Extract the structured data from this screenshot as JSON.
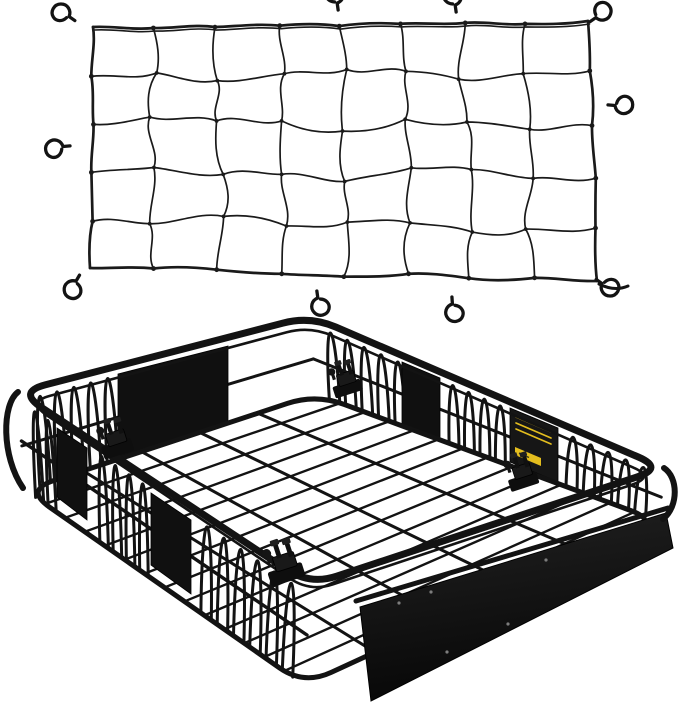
{
  "canvas": {
    "width": 679,
    "height": 709
  },
  "scene": {
    "type": "product-photo",
    "alt": "Black elastic bungee cargo net with steel hooks above a black steel roof rack cargo basket with mounting clamps",
    "items": [
      "elastic bungee cargo net with hooks",
      "steel roof rack cargo basket"
    ]
  },
  "colors": {
    "background": "#ffffff",
    "ink": "#131313",
    "strand": "#1a1a1a",
    "panel": "#101010",
    "panel_edge": "#2c2c2c",
    "fairing_top": "#222222",
    "fairing_bottom": "#070707",
    "label_plate": "#161616",
    "label_yellow": "#e3bd1e",
    "screw": "#7d7d7d"
  },
  "net": {
    "corners": {
      "tl": [
        93,
        27
      ],
      "tr": [
        588,
        21
      ],
      "br": [
        597,
        281
      ],
      "bl": [
        90,
        268
      ]
    },
    "cols": 8,
    "rows": 5,
    "border_width": 2.7,
    "strand_width": 1.7,
    "hook_count": 10,
    "hooks": [
      {
        "x": 74,
        "y": 20,
        "rot": -55
      },
      {
        "x": 338,
        "y": 9,
        "rot": -8
      },
      {
        "x": 456,
        "y": 11,
        "rot": -8
      },
      {
        "x": 591,
        "y": 21,
        "rot": 55
      },
      {
        "x": 609,
        "y": 105,
        "rot": 95
      },
      {
        "x": 69,
        "y": 146,
        "rot": -95
      },
      {
        "x": 79,
        "y": 276,
        "rot": -150
      },
      {
        "x": 317,
        "y": 292,
        "rot": 172
      },
      {
        "x": 452,
        "y": 298,
        "rot": 176
      },
      {
        "x": 597,
        "y": 280,
        "rot": 125,
        "tail": true
      }
    ]
  },
  "rack": {
    "rim": [
      [
        18,
        392
      ],
      [
        310,
        316
      ],
      [
        664,
        468
      ],
      [
        310,
        585
      ]
    ],
    "rim_inner": [
      [
        27,
        402
      ],
      [
        310,
        326
      ],
      [
        655,
        477
      ],
      [
        310,
        592
      ]
    ],
    "floor": [
      [
        25,
        490
      ],
      [
        316,
        394
      ],
      [
        659,
        521
      ],
      [
        304,
        685
      ]
    ],
    "long_bars": 13,
    "cross_bars": 4,
    "walls": {
      "far_left": {
        "arch_segs": [
          [
            0.04,
            0.33,
            5
          ]
        ]
      },
      "far_right": {
        "arch_segs": [
          [
            0.03,
            0.27,
            5
          ],
          [
            0.38,
            0.56,
            4
          ],
          [
            0.72,
            0.97,
            5
          ]
        ]
      },
      "near_left": {
        "arch_segs": [
          [
            0.03,
            0.12,
            2
          ],
          [
            0.26,
            0.45,
            4
          ],
          [
            0.62,
            0.97,
            6
          ]
        ]
      }
    },
    "panels": {
      "far_left": [
        [
          118,
          374
        ],
        [
          228,
          346
        ],
        [
          228,
          424
        ],
        [
          118,
          458
        ]
      ],
      "far_right": [
        [
          402,
          362
        ],
        [
          440,
          378
        ],
        [
          440,
          440
        ],
        [
          402,
          424
        ]
      ],
      "near_left_1": [
        [
          57,
          428
        ],
        [
          87,
          448
        ],
        [
          87,
          520
        ],
        [
          57,
          497
        ]
      ],
      "near_left_2": [
        [
          151,
          493
        ],
        [
          191,
          520
        ],
        [
          191,
          594
        ],
        [
          151,
          565
        ]
      ]
    },
    "fairing": [
      [
        360,
        607
      ],
      [
        666,
        513
      ],
      [
        673,
        548
      ],
      [
        371,
        701
      ]
    ],
    "fairing_rail": [
      [
        356,
        601
      ],
      [
        668,
        508
      ]
    ],
    "screws": [
      [
        399,
        603
      ],
      [
        431,
        592
      ],
      [
        447,
        652
      ],
      [
        508,
        624
      ],
      [
        546,
        560
      ]
    ],
    "label": {
      "plate": [
        [
          510,
          408
        ],
        [
          558,
          428
        ],
        [
          558,
          482
        ],
        [
          510,
          462
        ]
      ],
      "lines": [
        [
          516,
          417
        ],
        [
          516,
          423
        ],
        [
          516,
          429
        ]
      ],
      "line_dx": 35,
      "line_dy": 15,
      "sticker": [
        [
          515,
          447
        ],
        [
          541,
          458
        ],
        [
          541,
          466
        ],
        [
          515,
          455
        ]
      ]
    },
    "clamp_count": 4,
    "clamps": [
      [
        348,
        385,
        0.92
      ],
      [
        118,
        445,
        1.0
      ],
      [
        524,
        478,
        0.95
      ],
      [
        287,
        570,
        1.15
      ]
    ]
  }
}
